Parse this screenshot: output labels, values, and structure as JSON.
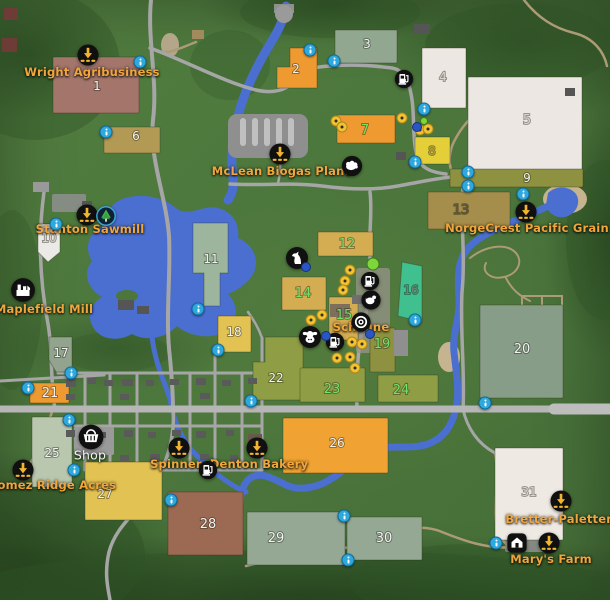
{
  "map": {
    "game_style": "farming-map-overview",
    "colors": {
      "label_orange": "#f0a63c",
      "label_white": "#f4f4f4",
      "number_white": "#f2f2f2",
      "number_green": "#72e26b",
      "number_faint": "#d9d3cc",
      "water": "#4a6fd0",
      "road": "#a6a6a6",
      "highway": "#b6b6b6",
      "trail": "#ab9b76",
      "info_marker": "#2fa8dc",
      "dot_yellow": "#f2c230",
      "dot_blue": "#2a55c4",
      "dot_green": "#7ed63a",
      "sell_icon_arrow": "#f2b52e",
      "icon_background": "#101010"
    },
    "fields": [
      {
        "num": "1",
        "rect": [
          53,
          57,
          86,
          56
        ],
        "fill": "#a3756b",
        "nc": "white",
        "np": [
          97,
          90
        ]
      },
      {
        "num": "2",
        "poly": "290,48 317,48 317,88 277,88 277,67 290,67",
        "fill": "#ef9a31",
        "nc": "white",
        "np": [
          296,
          73
        ]
      },
      {
        "num": "3",
        "rect": [
          335,
          30,
          62,
          33
        ],
        "fill": "#91a790",
        "nc": "white",
        "np": [
          367,
          48
        ]
      },
      {
        "num": "4",
        "rect": [
          422,
          48,
          44,
          60
        ],
        "fill": "#ece7e2",
        "nc": "faint",
        "np": [
          443,
          81
        ]
      },
      {
        "num": "5",
        "rect": [
          468,
          77,
          114,
          96
        ],
        "fill": "#ece7e2",
        "nc": "faint",
        "np": [
          527,
          124
        ],
        "fs": 13
      },
      {
        "num": "6",
        "rect": [
          104,
          127,
          56,
          26
        ],
        "fill": "#b29a54",
        "nc": "white",
        "np": [
          136,
          140
        ]
      },
      {
        "num": "7",
        "rect": [
          337,
          115,
          58,
          28
        ],
        "fill": "#ef9a31",
        "nc": "green",
        "np": [
          365,
          134
        ],
        "fs": 13
      },
      {
        "num": "8",
        "rect": [
          415,
          137,
          35,
          27
        ],
        "fill": "#e5cf39",
        "nc": "#b0a13c",
        "np": [
          432,
          155
        ]
      },
      {
        "num": "9",
        "rect": [
          450,
          169,
          133,
          18
        ],
        "fill": "#8d9140",
        "nc": "white",
        "np": [
          527,
          182
        ]
      },
      {
        "num": "10",
        "poly": "38,224 60,224 60,252 48,262 38,252",
        "fill": "#eceae6",
        "nc": "faint",
        "np": [
          49,
          242
        ]
      },
      {
        "num": "11",
        "poly": "193,223 228,223 228,273 220,273 220,306 204,306 204,273 193,273",
        "fill": "#9cb59c",
        "nc": "white",
        "np": [
          211,
          263
        ]
      },
      {
        "num": "12",
        "rect": [
          318,
          232,
          55,
          24
        ],
        "fill": "#d4ad52",
        "nc": "green",
        "np": [
          347,
          248
        ],
        "fs": 13
      },
      {
        "num": "13",
        "rect": [
          428,
          192,
          82,
          37
        ],
        "fill": "#a58e4c",
        "nc": "#5f5540",
        "np": [
          461,
          214
        ],
        "fs": 13
      },
      {
        "num": "14",
        "rect": [
          282,
          277,
          44,
          33
        ],
        "fill": "#d4ad52",
        "nc": "green",
        "np": [
          303,
          297
        ],
        "fs": 13
      },
      {
        "num": "15",
        "rect": [
          329,
          297,
          29,
          43
        ],
        "fill": "#d4ad52",
        "nc": "green",
        "np": [
          344,
          319
        ],
        "fs": 13
      },
      {
        "num": "16",
        "poly": "402,262 422,266 422,322 398,316",
        "fill": "#41c08f",
        "nc": "#6f8578",
        "np": [
          411,
          294
        ]
      },
      {
        "num": "17",
        "poly": "49,337 72,337 72,372 56,372 49,360",
        "fill": "#92a48e",
        "nc": "white",
        "np": [
          61,
          357
        ]
      },
      {
        "num": "18",
        "rect": [
          218,
          316,
          33,
          36
        ],
        "fill": "#e2c252",
        "nc": "white",
        "np": [
          234,
          336
        ]
      },
      {
        "num": "19",
        "rect": [
          370,
          328,
          25,
          44
        ],
        "fill": "#8d9140",
        "nc": "green",
        "np": [
          382,
          348
        ],
        "fs": 13
      },
      {
        "num": "20",
        "rect": [
          480,
          305,
          83,
          93
        ],
        "fill": "#879d88",
        "nc": "white",
        "np": [
          522,
          353
        ],
        "fs": 13
      },
      {
        "num": "21",
        "rect": [
          30,
          383,
          39,
          20
        ],
        "fill": "#ef9a31",
        "nc": "white",
        "np": [
          50,
          397
        ],
        "fs": 13
      },
      {
        "num": "22",
        "poly": "265,337 303,337 303,400 253,400 253,362 265,362",
        "fill": "#8f9d44",
        "nc": "white",
        "np": [
          276,
          382
        ]
      },
      {
        "num": "23",
        "rect": [
          300,
          368,
          65,
          34
        ],
        "fill": "#8f9d44",
        "nc": "green",
        "np": [
          332,
          393
        ],
        "fs": 13
      },
      {
        "num": "24",
        "rect": [
          378,
          375,
          60,
          27
        ],
        "fill": "#8f9d44",
        "nc": "green",
        "np": [
          401,
          394
        ],
        "fs": 13
      },
      {
        "num": "25",
        "rect": [
          32,
          417,
          40,
          70
        ],
        "fill": "#b9c7ae",
        "nc": "white",
        "np": [
          52,
          457
        ]
      },
      {
        "num": "26",
        "rect": [
          283,
          418,
          105,
          55
        ],
        "fill": "#f0a232",
        "nc": "white",
        "np": [
          337,
          447
        ]
      },
      {
        "num": "27",
        "rect": [
          85,
          462,
          77,
          58
        ],
        "fill": "#e2c252",
        "nc": "white",
        "np": [
          105,
          498
        ]
      },
      {
        "num": "28",
        "rect": [
          168,
          492,
          75,
          63
        ],
        "fill": "#9c6a53",
        "nc": "white",
        "np": [
          208,
          528
        ],
        "fs": 13
      },
      {
        "num": "29",
        "rect": [
          247,
          512,
          98,
          53
        ],
        "fill": "#94a894",
        "nc": "white",
        "np": [
          276,
          542
        ],
        "fs": 13
      },
      {
        "num": "30",
        "rect": [
          347,
          517,
          75,
          43
        ],
        "fill": "#94a894",
        "nc": "white",
        "np": [
          384,
          542
        ],
        "fs": 13
      },
      {
        "num": "31",
        "rect": [
          495,
          448,
          68,
          92
        ],
        "fill": "#efe9e3",
        "nc": "faint",
        "np": [
          529,
          496
        ]
      }
    ],
    "labels": [
      {
        "id": "wright",
        "text": "Wright Agribusiness",
        "x": 92,
        "y": 72
      },
      {
        "id": "mclean",
        "text": "McLean Biogas Plant",
        "x": 281,
        "y": 171
      },
      {
        "id": "stanton",
        "text": "Stanton Sawmill",
        "x": 90,
        "y": 229
      },
      {
        "id": "maplefield",
        "text": "Maplefield Mill",
        "x": 44,
        "y": 309
      },
      {
        "id": "norgecrest",
        "text": "NorgeCrest Pacific Grain",
        "x": 527,
        "y": 228
      },
      {
        "id": "scheune",
        "text": "Scheune",
        "x": 361,
        "y": 327
      },
      {
        "id": "shop",
        "text": "Shop",
        "x": 90,
        "y": 455,
        "white": true
      },
      {
        "id": "gomez",
        "text": "Gomez Ridge Acres",
        "x": 52,
        "y": 485
      },
      {
        "id": "spinnerei",
        "text": "Spinnerei",
        "x": 182,
        "y": 464
      },
      {
        "id": "denton",
        "text": "Denton Bakery",
        "x": 259,
        "y": 464
      },
      {
        "id": "bretter",
        "text": "Bretter-Paletten",
        "x": 560,
        "y": 519
      },
      {
        "id": "marys",
        "text": "Mary's Farm",
        "x": 551,
        "y": 559
      }
    ],
    "icons": [
      {
        "id": "wright-sell",
        "type": "sell",
        "x": 88,
        "y": 55
      },
      {
        "id": "mclean-sell",
        "type": "sell",
        "x": 280,
        "y": 154
      },
      {
        "id": "stanton-sell",
        "type": "sell",
        "x": 87,
        "y": 215
      },
      {
        "id": "sawmill-tree",
        "type": "tree",
        "x": 106,
        "y": 216
      },
      {
        "id": "maplefield-mill",
        "type": "mill",
        "x": 23,
        "y": 290
      },
      {
        "id": "norgecrest-sell",
        "type": "sell",
        "x": 526,
        "y": 212
      },
      {
        "id": "fuel-north",
        "type": "fuel",
        "x": 404,
        "y": 79
      },
      {
        "id": "sheep-pasture",
        "type": "sheep",
        "x": 352,
        "y": 166
      },
      {
        "id": "horse-paddock",
        "type": "horse",
        "x": 297,
        "y": 258
      },
      {
        "id": "fuel-scheune-north",
        "type": "fuel",
        "x": 370,
        "y": 281
      },
      {
        "id": "chicken-coop",
        "type": "chicken",
        "x": 371,
        "y": 300
      },
      {
        "id": "wool-roll",
        "type": "spiral",
        "x": 361,
        "y": 322
      },
      {
        "id": "cow-barn",
        "type": "cow",
        "x": 310,
        "y": 337
      },
      {
        "id": "fuel-scheune-south",
        "type": "fuel",
        "x": 335,
        "y": 342
      },
      {
        "id": "shop-cart",
        "type": "cart",
        "x": 91,
        "y": 437
      },
      {
        "id": "spinnerei-sell",
        "type": "sell",
        "x": 179,
        "y": 448
      },
      {
        "id": "fuel-town",
        "type": "fuel",
        "x": 208,
        "y": 470
      },
      {
        "id": "denton-sell",
        "type": "sell",
        "x": 257,
        "y": 448
      },
      {
        "id": "gomez-sell",
        "type": "sell",
        "x": 23,
        "y": 470
      },
      {
        "id": "bretter-sell",
        "type": "sell",
        "x": 561,
        "y": 501
      },
      {
        "id": "marys-barn",
        "type": "barn",
        "x": 517,
        "y": 543
      },
      {
        "id": "marys-sell",
        "type": "sell",
        "x": 549,
        "y": 543
      }
    ],
    "info_markers": [
      [
        140,
        62
      ],
      [
        310,
        50
      ],
      [
        334,
        61
      ],
      [
        424,
        109
      ],
      [
        415,
        162
      ],
      [
        468,
        172
      ],
      [
        468,
        186
      ],
      [
        523,
        194
      ],
      [
        106,
        132
      ],
      [
        56,
        224
      ],
      [
        198,
        309
      ],
      [
        415,
        320
      ],
      [
        218,
        350
      ],
      [
        251,
        401
      ],
      [
        71,
        373
      ],
      [
        28,
        388
      ],
      [
        69,
        420
      ],
      [
        74,
        470
      ],
      [
        171,
        500
      ],
      [
        344,
        516
      ],
      [
        348,
        560
      ],
      [
        496,
        543
      ],
      [
        485,
        403
      ]
    ],
    "yellow_dots": [
      [
        336,
        121
      ],
      [
        342,
        127
      ],
      [
        402,
        118
      ],
      [
        420,
        130
      ],
      [
        428,
        129
      ],
      [
        350,
        270
      ],
      [
        345,
        281
      ],
      [
        343,
        290
      ],
      [
        322,
        315
      ],
      [
        311,
        320
      ],
      [
        352,
        342
      ],
      [
        362,
        344
      ],
      [
        350,
        357
      ],
      [
        337,
        358
      ],
      [
        355,
        368
      ]
    ],
    "blue_dots": [
      [
        306,
        267
      ],
      [
        326,
        336
      ],
      [
        370,
        334
      ],
      [
        417,
        127
      ]
    ],
    "green_dots": [
      [
        373,
        264,
        11
      ],
      [
        424,
        121,
        6
      ]
    ]
  }
}
